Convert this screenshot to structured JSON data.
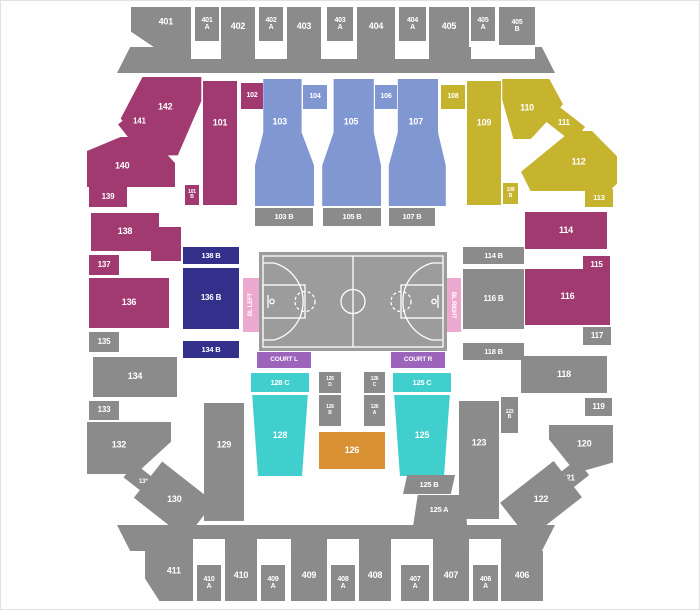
{
  "canvas": {
    "width": 700,
    "height": 610,
    "background": "#fefefe"
  },
  "colors": {
    "gray": "#8b8b8b",
    "white": "#ffffff",
    "magenta": "#a23a72",
    "blue": "#8097d2",
    "yellow": "#c6b42e",
    "navy": "#32308a",
    "cyan": "#40cfcc",
    "orange": "#da9134",
    "pink": "#eca8ce",
    "purple": "#9c64ba",
    "court": "#9c9c9c",
    "court_line": "#ffffff"
  },
  "court": {
    "name": "basketball-court"
  },
  "sections": [
    {
      "name": "top-concourse",
      "label": "",
      "color": "gray",
      "x": 116,
      "y": 46,
      "w": 438,
      "h": 26,
      "clip": "3% 0, 97% 0, 100% 100%, 0 100%",
      "inter": false
    },
    {
      "name": "concourse-notch",
      "label": "",
      "color": "white",
      "x": 190,
      "y": 46,
      "w": 30,
      "h": 12,
      "inter": false
    },
    {
      "name": "concourse-notch",
      "label": "",
      "color": "white",
      "x": 254,
      "y": 46,
      "w": 32,
      "h": 12,
      "inter": false
    },
    {
      "name": "concourse-notch",
      "label": "",
      "color": "white",
      "x": 320,
      "y": 46,
      "w": 36,
      "h": 12,
      "inter": false
    },
    {
      "name": "concourse-notch",
      "label": "",
      "color": "white",
      "x": 394,
      "y": 46,
      "w": 34,
      "h": 12,
      "inter": false
    },
    {
      "name": "concourse-notch",
      "label": "",
      "color": "white",
      "x": 470,
      "y": 46,
      "w": 64,
      "h": 12,
      "inter": false
    },
    {
      "name": "bottom-concourse",
      "label": "",
      "color": "gray",
      "x": 116,
      "y": 524,
      "w": 438,
      "h": 26,
      "clip": "0 0, 100% 0, 97% 100%, 3% 100%",
      "inter": false
    },
    {
      "name": "concourse-notch",
      "label": "",
      "color": "white",
      "x": 192,
      "y": 538,
      "w": 32,
      "h": 12,
      "inter": false
    },
    {
      "name": "concourse-notch",
      "label": "",
      "color": "white",
      "x": 256,
      "y": 538,
      "w": 34,
      "h": 12,
      "inter": false
    },
    {
      "name": "concourse-notch",
      "label": "",
      "color": "white",
      "x": 326,
      "y": 538,
      "w": 32,
      "h": 12,
      "inter": false
    },
    {
      "name": "concourse-notch",
      "label": "",
      "color": "white",
      "x": 390,
      "y": 538,
      "w": 42,
      "h": 12,
      "inter": false
    },
    {
      "name": "concourse-notch",
      "label": "",
      "color": "white",
      "x": 468,
      "y": 538,
      "w": 32,
      "h": 12,
      "inter": false
    },
    {
      "name": "section-401",
      "label": "401",
      "color": "gray",
      "x": 130,
      "y": 6,
      "w": 60,
      "h": 40,
      "fs": 9,
      "clip": "0 0, 100% 0, 100% 100%, 38% 100%, 0 62%",
      "lx": 58,
      "ly": 38
    },
    {
      "name": "section-401A",
      "label": "401\nA",
      "color": "gray",
      "x": 194,
      "y": 6,
      "w": 24,
      "h": 34,
      "fs": 7
    },
    {
      "name": "section-402",
      "label": "402",
      "color": "gray",
      "x": 220,
      "y": 6,
      "w": 34,
      "h": 40,
      "fs": 9
    },
    {
      "name": "section-402A",
      "label": "402\nA",
      "color": "gray",
      "x": 258,
      "y": 6,
      "w": 24,
      "h": 34,
      "fs": 7
    },
    {
      "name": "section-403",
      "label": "403",
      "color": "gray",
      "x": 286,
      "y": 6,
      "w": 34,
      "h": 40,
      "fs": 9
    },
    {
      "name": "section-403A",
      "label": "403\nA",
      "color": "gray",
      "x": 326,
      "y": 6,
      "w": 26,
      "h": 34,
      "fs": 7
    },
    {
      "name": "section-404",
      "label": "404",
      "color": "gray",
      "x": 356,
      "y": 6,
      "w": 38,
      "h": 40,
      "fs": 9
    },
    {
      "name": "section-404A",
      "label": "404\nA",
      "color": "gray",
      "x": 398,
      "y": 6,
      "w": 27,
      "h": 34,
      "fs": 7
    },
    {
      "name": "section-405",
      "label": "405",
      "color": "gray",
      "x": 428,
      "y": 6,
      "w": 40,
      "h": 40,
      "fs": 9
    },
    {
      "name": "section-405A",
      "label": "405\nA",
      "color": "gray",
      "x": 470,
      "y": 6,
      "w": 24,
      "h": 34,
      "fs": 7
    },
    {
      "name": "section-405B",
      "label": "405\nB",
      "color": "gray",
      "x": 498,
      "y": 6,
      "w": 36,
      "h": 38,
      "fs": 7
    },
    {
      "name": "section-142",
      "label": "142",
      "color": "magenta",
      "x": 118,
      "y": 76,
      "w": 84,
      "h": 80,
      "fs": 9,
      "clip": "28% 0, 98% 0, 98% 30%, 70% 98%, 40% 98%, 2% 52%",
      "lx": 55,
      "ly": 38
    },
    {
      "name": "section-141",
      "label": "141",
      "color": "magenta",
      "x": 120,
      "y": 110,
      "w": 36,
      "h": 22,
      "fs": 8,
      "rot": -38
    },
    {
      "name": "section-140",
      "label": "140",
      "color": "magenta",
      "x": 86,
      "y": 136,
      "w": 88,
      "h": 50,
      "fs": 9,
      "clip": "0 28%, 38% 0, 72% 0, 100% 52%, 100% 100%, 0 100%",
      "lx": 40,
      "ly": 58
    },
    {
      "name": "section-139",
      "label": "139",
      "color": "magenta",
      "x": 88,
      "y": 186,
      "w": 38,
      "h": 20,
      "fs": 8
    },
    {
      "name": "section-138",
      "label": "138",
      "color": "magenta",
      "x": 90,
      "y": 212,
      "w": 68,
      "h": 38,
      "fs": 9
    },
    {
      "name": "section-138-part",
      "label": "",
      "color": "magenta",
      "x": 150,
      "y": 226,
      "w": 30,
      "h": 34,
      "inter": false
    },
    {
      "name": "section-137",
      "label": "137",
      "color": "magenta",
      "x": 88,
      "y": 254,
      "w": 30,
      "h": 20,
      "fs": 8
    },
    {
      "name": "section-136",
      "label": "136",
      "color": "magenta",
      "x": 88,
      "y": 277,
      "w": 80,
      "h": 50,
      "fs": 9
    },
    {
      "name": "section-135",
      "label": "135",
      "color": "gray",
      "x": 88,
      "y": 331,
      "w": 30,
      "h": 20,
      "fs": 8
    },
    {
      "name": "section-134",
      "label": "134",
      "color": "gray",
      "x": 92,
      "y": 356,
      "w": 84,
      "h": 40,
      "fs": 9
    },
    {
      "name": "section-133",
      "label": "133",
      "color": "gray",
      "x": 88,
      "y": 400,
      "w": 30,
      "h": 19,
      "fs": 8
    },
    {
      "name": "section-132",
      "label": "132",
      "color": "gray",
      "x": 86,
      "y": 421,
      "w": 84,
      "h": 52,
      "fs": 9,
      "clip": "0 0, 100% 0, 100% 38%, 58% 100%, 0 100%",
      "lx": 38,
      "ly": 45
    },
    {
      "name": "section-131",
      "label": "131",
      "color": "gray",
      "x": 124,
      "y": 472,
      "w": 38,
      "h": 18,
      "fs": 6,
      "rot": 38
    },
    {
      "name": "section-130",
      "label": "130",
      "color": "gray",
      "x": 140,
      "y": 476,
      "w": 66,
      "h": 46,
      "fs": 9,
      "rot": 38
    },
    {
      "name": "section-129",
      "label": "129",
      "color": "gray",
      "x": 203,
      "y": 402,
      "w": 40,
      "h": 118,
      "fs": 9,
      "lx": 50,
      "ly": 36
    },
    {
      "name": "section-101",
      "label": "101",
      "color": "magenta",
      "x": 202,
      "y": 80,
      "w": 34,
      "h": 124,
      "fs": 9,
      "lx": 50,
      "ly": 34
    },
    {
      "name": "section-102",
      "label": "102",
      "color": "magenta",
      "x": 240,
      "y": 82,
      "w": 22,
      "h": 26,
      "fs": 7
    },
    {
      "name": "section-101B",
      "label": "101\nB",
      "color": "magenta",
      "x": 184,
      "y": 184,
      "w": 14,
      "h": 20,
      "fs": 5
    },
    {
      "name": "section-103",
      "label": "103",
      "color": "blue",
      "x": 254,
      "y": 78,
      "w": 59,
      "h": 127,
      "fs": 9,
      "clip": "14% 0, 79% 0, 79% 42%, 100% 68%, 100% 100%, 0 100%, 0 68%, 14% 42%",
      "lx": 42,
      "ly": 34
    },
    {
      "name": "section-104",
      "label": "104",
      "color": "blue",
      "x": 302,
      "y": 84,
      "w": 24,
      "h": 24,
      "fs": 7
    },
    {
      "name": "section-105",
      "label": "105",
      "color": "blue",
      "x": 320,
      "y": 78,
      "w": 60,
      "h": 127,
      "fs": 9,
      "clip": "21% 0, 88% 0, 88% 42%, 100% 68%, 100% 100%, 2% 100%, 2% 68%, 21% 42%",
      "lx": 50,
      "ly": 34
    },
    {
      "name": "section-106",
      "label": "106",
      "color": "blue",
      "x": 374,
      "y": 84,
      "w": 22,
      "h": 24,
      "fs": 7
    },
    {
      "name": "section-107",
      "label": "107",
      "color": "blue",
      "x": 386,
      "y": 78,
      "w": 60,
      "h": 127,
      "fs": 9,
      "clip": "18% 0, 85% 0, 85% 42%, 98% 68%, 98% 100%, 3% 100%, 3% 68%, 18% 42%",
      "lx": 48,
      "ly": 34
    },
    {
      "name": "section-108",
      "label": "108",
      "color": "yellow",
      "x": 440,
      "y": 84,
      "w": 24,
      "h": 24,
      "fs": 7
    },
    {
      "name": "section-103B",
      "label": "103 B",
      "color": "gray",
      "x": 254,
      "y": 207,
      "w": 58,
      "h": 18,
      "fs": 7.5
    },
    {
      "name": "section-105B",
      "label": "105 B",
      "color": "gray",
      "x": 322,
      "y": 207,
      "w": 58,
      "h": 18,
      "fs": 7.5
    },
    {
      "name": "section-107B",
      "label": "107 B",
      "color": "gray",
      "x": 388,
      "y": 207,
      "w": 46,
      "h": 18,
      "fs": 7.5
    },
    {
      "name": "section-109",
      "label": "109",
      "color": "yellow",
      "x": 466,
      "y": 80,
      "w": 34,
      "h": 124,
      "fs": 9,
      "lx": 50,
      "ly": 34
    },
    {
      "name": "section-109B",
      "label": "109\nB",
      "color": "yellow",
      "x": 502,
      "y": 182,
      "w": 15,
      "h": 21,
      "fs": 5
    },
    {
      "name": "section-110",
      "label": "110",
      "color": "yellow",
      "x": 500,
      "y": 78,
      "w": 62,
      "h": 60,
      "fs": 9,
      "clip": "2% 0, 78% 0, 100% 42%, 48% 100%, 20% 100%, 2% 35%",
      "lx": 42,
      "ly": 48
    },
    {
      "name": "section-111",
      "label": "111",
      "color": "yellow",
      "x": 544,
      "y": 112,
      "w": 38,
      "h": 20,
      "fs": 8,
      "rot": 38
    },
    {
      "name": "section-112",
      "label": "112",
      "color": "yellow",
      "x": 520,
      "y": 130,
      "w": 96,
      "h": 60,
      "fs": 9,
      "clip": "0 68%, 52% 0, 74% 0, 100% 42%, 100% 88%, 92% 100%, 10% 100%",
      "lx": 60,
      "ly": 52
    },
    {
      "name": "section-113",
      "label": "113",
      "color": "yellow",
      "x": 584,
      "y": 188,
      "w": 28,
      "h": 18,
      "fs": 7.5
    },
    {
      "name": "section-138B",
      "label": "138 B",
      "color": "navy",
      "x": 182,
      "y": 246,
      "w": 56,
      "h": 17,
      "fs": 7.5
    },
    {
      "name": "section-136B",
      "label": "136 B",
      "color": "navy",
      "x": 182,
      "y": 267,
      "w": 56,
      "h": 61,
      "fs": 8
    },
    {
      "name": "section-134B",
      "label": "134 B",
      "color": "navy",
      "x": 182,
      "y": 340,
      "w": 56,
      "h": 17,
      "fs": 7.5
    },
    {
      "name": "bl-left-tab",
      "label": "BL LEFT",
      "color": "pink",
      "x": 242,
      "y": 277,
      "w": 16,
      "h": 54,
      "fs": 6,
      "vert": "up"
    },
    {
      "name": "bl-right-tab",
      "label": "BL RIGHT",
      "color": "pink",
      "x": 444,
      "y": 277,
      "w": 16,
      "h": 54,
      "fs": 6,
      "vert": "down"
    },
    {
      "name": "section-114",
      "label": "114",
      "color": "magenta",
      "x": 524,
      "y": 211,
      "w": 82,
      "h": 37,
      "fs": 9
    },
    {
      "name": "section-114B",
      "label": "114 B",
      "color": "gray",
      "x": 462,
      "y": 246,
      "w": 61,
      "h": 17,
      "fs": 7.5
    },
    {
      "name": "section-115",
      "label": "115",
      "color": "magenta",
      "x": 582,
      "y": 255,
      "w": 27,
      "h": 19,
      "fs": 8
    },
    {
      "name": "section-116B",
      "label": "116 B",
      "color": "gray",
      "x": 462,
      "y": 268,
      "w": 61,
      "h": 60,
      "fs": 8
    },
    {
      "name": "section-116",
      "label": "116",
      "color": "magenta",
      "x": 524,
      "y": 268,
      "w": 85,
      "h": 56,
      "fs": 9
    },
    {
      "name": "section-117",
      "label": "117",
      "color": "gray",
      "x": 582,
      "y": 326,
      "w": 28,
      "h": 18,
      "fs": 8
    },
    {
      "name": "section-118B",
      "label": "118 B",
      "color": "gray",
      "x": 462,
      "y": 342,
      "w": 61,
      "h": 17,
      "fs": 7.5
    },
    {
      "name": "section-118",
      "label": "118",
      "color": "gray",
      "x": 520,
      "y": 355,
      "w": 86,
      "h": 37,
      "fs": 9
    },
    {
      "name": "section-119",
      "label": "119",
      "color": "gray",
      "x": 584,
      "y": 397,
      "w": 27,
      "h": 18,
      "fs": 8
    },
    {
      "name": "section-123B",
      "label": "123\nB",
      "color": "gray",
      "x": 500,
      "y": 396,
      "w": 17,
      "h": 36,
      "fs": 5
    },
    {
      "name": "section-123",
      "label": "123",
      "color": "gray",
      "x": 458,
      "y": 400,
      "w": 40,
      "h": 118,
      "fs": 9,
      "lx": 50,
      "ly": 36
    },
    {
      "name": "section-120",
      "label": "120",
      "color": "gray",
      "x": 548,
      "y": 424,
      "w": 64,
      "h": 48,
      "fs": 9,
      "clip": "0 0, 100% 0, 100% 78%, 42% 100%, 0 30%",
      "lx": 55,
      "ly": 40
    },
    {
      "name": "section-121",
      "label": "121",
      "color": "gray",
      "x": 548,
      "y": 468,
      "w": 38,
      "h": 20,
      "fs": 8,
      "rot": -38
    },
    {
      "name": "section-122",
      "label": "122",
      "color": "gray",
      "x": 506,
      "y": 476,
      "w": 68,
      "h": 46,
      "fs": 9,
      "rot": -38
    },
    {
      "name": "court-l-tab",
      "label": "COURT L",
      "color": "purple",
      "x": 256,
      "y": 351,
      "w": 54,
      "h": 16,
      "fs": 6.5
    },
    {
      "name": "court-r-tab",
      "label": "COURT R",
      "color": "purple",
      "x": 390,
      "y": 351,
      "w": 54,
      "h": 16,
      "fs": 6.5
    },
    {
      "name": "section-128C",
      "label": "128 C",
      "color": "cyan",
      "x": 250,
      "y": 372,
      "w": 58,
      "h": 19,
      "fs": 7.5
    },
    {
      "name": "section-125C",
      "label": "125 C",
      "color": "cyan",
      "x": 392,
      "y": 372,
      "w": 58,
      "h": 19,
      "fs": 7.5
    },
    {
      "name": "section-126D",
      "label": "126\nD",
      "color": "gray",
      "x": 318,
      "y": 371,
      "w": 22,
      "h": 21,
      "fs": 5
    },
    {
      "name": "section-126C",
      "label": "126\nC",
      "color": "gray",
      "x": 363,
      "y": 371,
      "w": 21,
      "h": 21,
      "fs": 5
    },
    {
      "name": "section-126B",
      "label": "126\nB",
      "color": "gray",
      "x": 318,
      "y": 394,
      "w": 22,
      "h": 31,
      "fs": 5
    },
    {
      "name": "section-126A",
      "label": "126\nA",
      "color": "gray",
      "x": 363,
      "y": 394,
      "w": 21,
      "h": 31,
      "fs": 5
    },
    {
      "name": "section-128",
      "label": "128",
      "color": "cyan",
      "x": 250,
      "y": 394,
      "w": 58,
      "h": 81,
      "fs": 9,
      "clip": "2% 0, 98% 0, 88% 100%, 12% 100%"
    },
    {
      "name": "section-125",
      "label": "125",
      "color": "cyan",
      "x": 392,
      "y": 394,
      "w": 58,
      "h": 81,
      "fs": 9,
      "clip": "2% 0, 98% 0, 88% 100%, 12% 100%"
    },
    {
      "name": "section-126",
      "label": "126",
      "color": "orange",
      "x": 318,
      "y": 431,
      "w": 66,
      "h": 37,
      "fs": 9
    },
    {
      "name": "section-125B",
      "label": "125 B",
      "color": "gray",
      "x": 402,
      "y": 474,
      "w": 52,
      "h": 19,
      "fs": 7.5,
      "clip": "8% 0, 100% 0, 92% 100%, 0 100%"
    },
    {
      "name": "section-125A",
      "label": "125 A",
      "color": "gray",
      "x": 410,
      "y": 494,
      "w": 56,
      "h": 30,
      "fs": 7.5,
      "clip": "12% 0, 96% 0, 100% 100%, 4% 100%"
    },
    {
      "name": "section-411",
      "label": "411",
      "color": "gray",
      "x": 144,
      "y": 550,
      "w": 48,
      "h": 50,
      "fs": 9,
      "clip": "0 0, 100% 0, 100% 100%, 30% 100%, 0 55%",
      "lx": 60,
      "ly": 40
    },
    {
      "name": "section-410A",
      "label": "410\nA",
      "color": "gray",
      "x": 196,
      "y": 564,
      "w": 24,
      "h": 36,
      "fs": 7
    },
    {
      "name": "section-410",
      "label": "410",
      "color": "gray",
      "x": 224,
      "y": 550,
      "w": 32,
      "h": 50,
      "fs": 9
    },
    {
      "name": "section-409A",
      "label": "409\nA",
      "color": "gray",
      "x": 260,
      "y": 564,
      "w": 24,
      "h": 36,
      "fs": 7
    },
    {
      "name": "section-409",
      "label": "409",
      "color": "gray",
      "x": 290,
      "y": 550,
      "w": 36,
      "h": 50,
      "fs": 9
    },
    {
      "name": "section-408A",
      "label": "408\nA",
      "color": "gray",
      "x": 330,
      "y": 564,
      "w": 24,
      "h": 36,
      "fs": 7
    },
    {
      "name": "section-408",
      "label": "408",
      "color": "gray",
      "x": 358,
      "y": 550,
      "w": 32,
      "h": 50,
      "fs": 9
    },
    {
      "name": "section-407A",
      "label": "407\nA",
      "color": "gray",
      "x": 400,
      "y": 564,
      "w": 28,
      "h": 36,
      "fs": 7
    },
    {
      "name": "section-407",
      "label": "407",
      "color": "gray",
      "x": 432,
      "y": 550,
      "w": 36,
      "h": 50,
      "fs": 9
    },
    {
      "name": "section-406A",
      "label": "406\nA",
      "color": "gray",
      "x": 472,
      "y": 564,
      "w": 25,
      "h": 36,
      "fs": 7
    },
    {
      "name": "section-406",
      "label": "406",
      "color": "gray",
      "x": 500,
      "y": 550,
      "w": 42,
      "h": 50,
      "fs": 9
    }
  ]
}
